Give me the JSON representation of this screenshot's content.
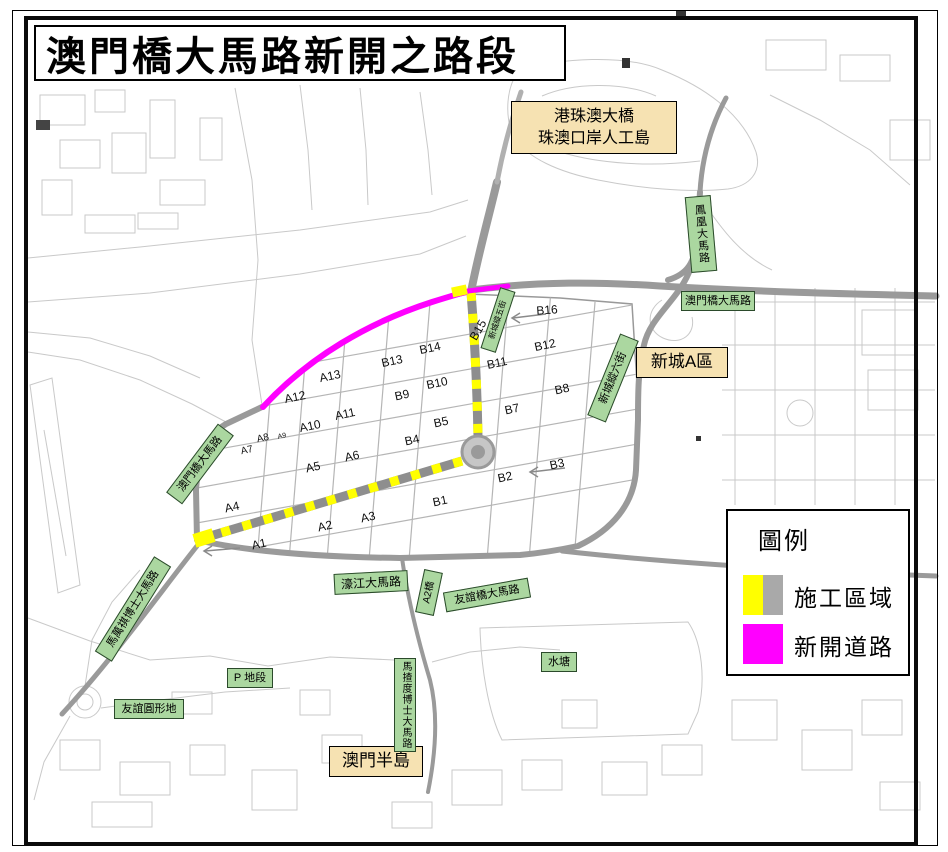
{
  "title": "澳門橋大馬路新開之路段",
  "legend": {
    "title": "圖例",
    "items": [
      {
        "label": "施工區域",
        "colors": [
          "#ffff00",
          "#a9a9a9"
        ]
      },
      {
        "label": "新開道路",
        "colors": [
          "#ff00ff",
          "#ff00ff"
        ]
      }
    ]
  },
  "areas": {
    "hzmb": {
      "line1": "港珠澳大橋",
      "line2": "珠澳口岸人工島"
    },
    "zone_a": "新城A區",
    "peninsula": "澳門半島"
  },
  "roads": {
    "fenghuang": "鳳凰大馬路",
    "macau_bridge_ave_east": "澳門橋大馬路",
    "macau_bridge_ave_west": "澳門橋大馬路",
    "new_town_street_6": "新城縱六街",
    "new_town_street_5": "新城縱五街",
    "hou_kong": "濠江大馬路",
    "a2_bridge": "A2橋",
    "friendship_bridge": "友誼橋大馬路",
    "ma_man_kei": "馬萬祺博士大馬路",
    "friendship_roundabout": "友誼圓形地",
    "p_lot": "P 地段",
    "machado": "馬揸度博士大馬路",
    "reservoir": "水塘"
  },
  "blocks": [
    "A1",
    "A2",
    "A3",
    "A4",
    "A5",
    "A6",
    "A7",
    "A8",
    "A9",
    "A10",
    "A11",
    "A12",
    "A13",
    "B1",
    "B2",
    "B3",
    "B4",
    "B5",
    "B7",
    "B8",
    "B9",
    "B10",
    "B11",
    "B12",
    "B13",
    "B14",
    "B15",
    "B16"
  ],
  "colors": {
    "new_road": "#ff00ff",
    "construction_yellow": "#ffff00",
    "construction_gray": "#a9a9a9",
    "road_label_bg": "#abd7a0",
    "area_label_bg": "#f6e2b2"
  }
}
